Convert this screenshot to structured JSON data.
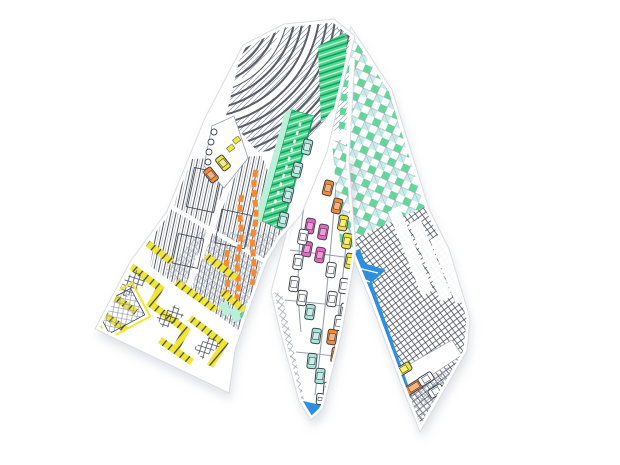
{
  "image": {
    "type": "product-photo",
    "subject": "silk twilly ribbon scarf folded into an inverted V",
    "background": "white",
    "print_theme": "hand-drawn aerial city map with line-art buildings and small colored cars"
  },
  "palette": {
    "background": "#ffffff",
    "line": "#3f4551",
    "lineSoft": "#99a1af",
    "green": "#4ed78e",
    "greenDark": "#16a05f",
    "mint": "#b9f0d6",
    "tealLight": "#c2ebe7",
    "teal": "#a9e8d6",
    "yellow": "#f2e632",
    "orange": "#f58a35",
    "pink": "#ef64c3",
    "blue": "#2e8fdf",
    "purple": "#b35ec2",
    "white": "#ffffff",
    "hem": "#d6dade",
    "shadow": "#c2c7d0",
    "innerShadow": "#a8aeba"
  },
  "scarf": {
    "fold": "top center",
    "bands": [
      {
        "id": "left-band",
        "position": "arm running to lower left, angled cut end",
        "features": [
          "curved-arena-rooftop",
          "green-striped-building",
          "vertical-hatched-towers",
          "orange-winding-roads",
          "yellow-striped-rooftops",
          "small-street-with-cars"
        ]
      },
      {
        "id": "center-tail",
        "position": "front tail hanging to bottom middle, pointed end",
        "features": [
          "avenue-with-parked-cars",
          "checkered-facade",
          "blue-tip"
        ]
      },
      {
        "id": "right-band",
        "position": "arm running to lower right, pointed end",
        "features": [
          "green-checkered-facade",
          "crosshatched-tower",
          "white-window-stripes",
          "blue-hem-stripe",
          "street-with-cars",
          "purple-tip"
        ]
      }
    ],
    "cars": [
      {
        "band": "left",
        "color": "yellow",
        "x": 223,
        "y": 163,
        "r": -38
      },
      {
        "band": "left",
        "color": "orange",
        "x": 211,
        "y": 175,
        "r": -38
      },
      {
        "band": "left",
        "color": "teal",
        "x": 307,
        "y": 147,
        "r": 14
      },
      {
        "band": "left",
        "color": "teal",
        "x": 297,
        "y": 170,
        "r": 14
      },
      {
        "band": "left",
        "color": "teal",
        "x": 288,
        "y": 195,
        "r": 14
      },
      {
        "band": "left",
        "color": "teal",
        "x": 283,
        "y": 220,
        "r": 14
      },
      {
        "band": "center",
        "color": "white",
        "x": 316,
        "y": 118,
        "r": 10
      },
      {
        "band": "center",
        "color": "orange",
        "x": 328,
        "y": 188,
        "r": 14
      },
      {
        "band": "center",
        "color": "orange",
        "x": 337,
        "y": 206,
        "r": 14
      },
      {
        "band": "center",
        "color": "pink",
        "x": 310,
        "y": 226,
        "r": 10
      },
      {
        "band": "center",
        "color": "pink",
        "x": 323,
        "y": 232,
        "r": 10
      },
      {
        "band": "center",
        "color": "pink",
        "x": 307,
        "y": 249,
        "r": 10
      },
      {
        "band": "center",
        "color": "pink",
        "x": 320,
        "y": 255,
        "r": 10
      },
      {
        "band": "center",
        "color": "yellow",
        "x": 343,
        "y": 223,
        "r": 10
      },
      {
        "band": "center",
        "color": "yellow",
        "x": 347,
        "y": 241,
        "r": 10
      },
      {
        "band": "center",
        "color": "yellow",
        "x": 350,
        "y": 261,
        "r": 10
      },
      {
        "band": "center",
        "color": "white",
        "x": 303,
        "y": 237,
        "r": 10
      },
      {
        "band": "center",
        "color": "white",
        "x": 298,
        "y": 262,
        "r": 8
      },
      {
        "band": "center",
        "color": "white",
        "x": 294,
        "y": 284,
        "r": 8
      },
      {
        "band": "center",
        "color": "white",
        "x": 302,
        "y": 298,
        "r": 8
      },
      {
        "band": "center",
        "color": "white",
        "x": 331,
        "y": 270,
        "r": 8
      },
      {
        "band": "center",
        "color": "white",
        "x": 344,
        "y": 286,
        "r": 8
      },
      {
        "band": "center",
        "color": "white",
        "x": 332,
        "y": 299,
        "r": 8
      },
      {
        "band": "center",
        "color": "white",
        "x": 345,
        "y": 311,
        "r": 8
      },
      {
        "band": "center",
        "color": "teal",
        "x": 310,
        "y": 312,
        "r": 8
      },
      {
        "band": "center",
        "color": "teal",
        "x": 316,
        "y": 336,
        "r": 8
      },
      {
        "band": "center",
        "color": "teal",
        "x": 312,
        "y": 361,
        "r": 6
      },
      {
        "band": "center",
        "color": "teal",
        "x": 320,
        "y": 376,
        "r": 6
      },
      {
        "band": "center",
        "color": "orange",
        "x": 332,
        "y": 337,
        "r": 8
      },
      {
        "band": "center",
        "color": "orange",
        "x": 336,
        "y": 355,
        "r": 8
      },
      {
        "band": "center",
        "color": "white",
        "x": 339,
        "y": 323,
        "r": 8
      },
      {
        "band": "center",
        "color": "white",
        "x": 328,
        "y": 390,
        "r": 5
      },
      {
        "band": "center",
        "color": "white",
        "x": 320,
        "y": 399,
        "r": 5,
        "w": 7,
        "h": 11
      },
      {
        "band": "right",
        "color": "yellow",
        "x": 404,
        "y": 369,
        "r": 58
      },
      {
        "band": "right",
        "color": "orange",
        "x": 414,
        "y": 387,
        "r": 58,
        "w": 9,
        "h": 19
      },
      {
        "band": "right",
        "color": "white",
        "x": 426,
        "y": 379,
        "r": 58
      },
      {
        "band": "right",
        "color": "white",
        "x": 436,
        "y": 391,
        "r": 58
      }
    ]
  }
}
